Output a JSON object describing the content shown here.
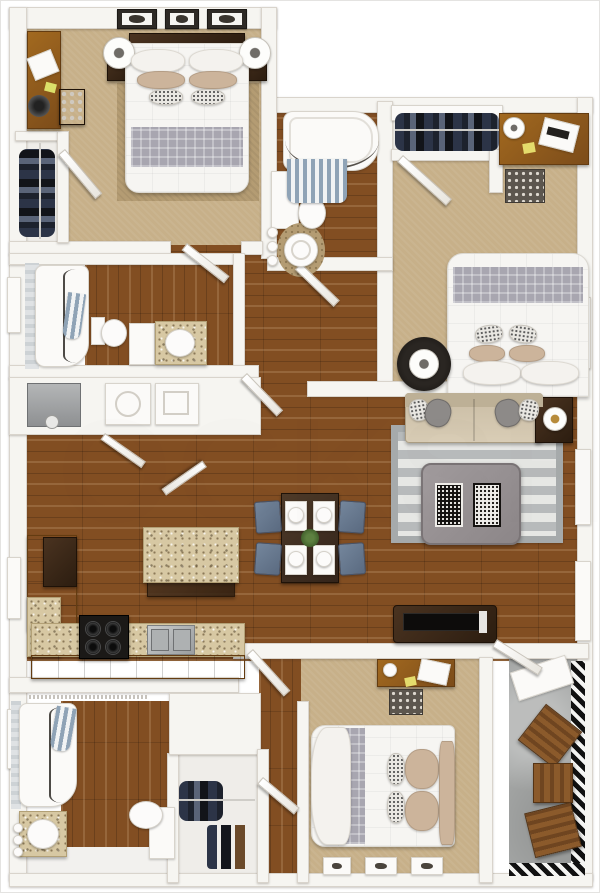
{
  "image": {
    "type": "3d-rendered-apartment-floor-plan",
    "width_px": 600,
    "height_px": 893,
    "view": "top-down dollhouse render, no visible labels"
  },
  "watermark": {
    "text": "OCKSHE",
    "opacity": 0.1
  },
  "palette": {
    "wall": "#f6f5f1",
    "walledge": "#d9d4cc",
    "carpet": "#c7b089",
    "rugtan": "#b49c73",
    "wood": "#824e22",
    "granite": "#d7c8a3",
    "tile": "#f2f1ee",
    "concrete": "#a5a7a6",
    "linen": "#f6f5f2",
    "plaid": "#a8a6b0",
    "pillowtan": "#ccb49b",
    "navy": "#2c3447",
    "slate": "#64768c",
    "espresso": "#34231a",
    "black": "#161412",
    "green": "#4c6b34",
    "note_yellow": "#e4dc6c",
    "stripe_curtain": "#8fa3b6"
  },
  "rooms_visible": [
    "bedroom-top-left",
    "bathroom-top-middle",
    "closet-top-left",
    "bedroom-top-right",
    "closet-top-right",
    "bathroom-mid-left",
    "laundry-closet",
    "kitchen",
    "dining-area",
    "living-room",
    "bedroom-bottom",
    "bathroom-bottom-left",
    "closet-bottom",
    "patio"
  ]
}
